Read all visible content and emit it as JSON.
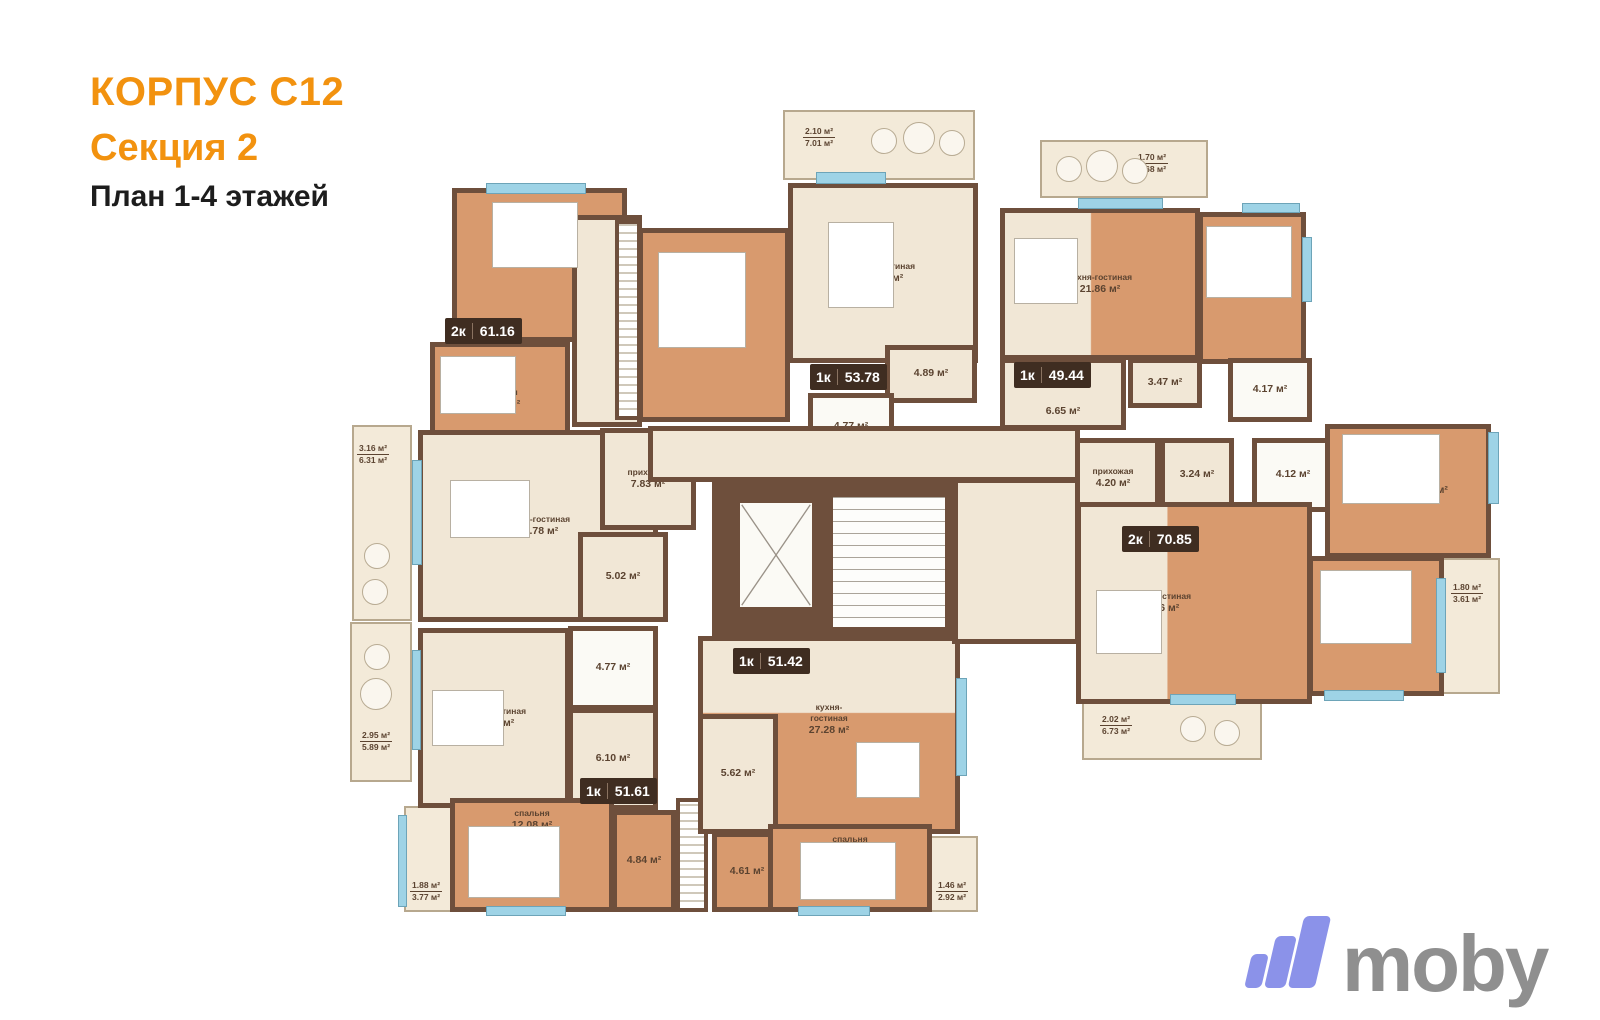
{
  "title": {
    "building": "КОРПУС С12",
    "section": "Секция 2",
    "plan": "План 1-4 этажей"
  },
  "apartments": {
    "a2k_6116": {
      "type": "2к",
      "area": "61.16"
    },
    "a1k_5378": {
      "type": "1к",
      "area": "53.78"
    },
    "a1k_4944": {
      "type": "1к",
      "area": "49.44"
    },
    "a2k_7085": {
      "type": "2к",
      "area": "70.85"
    },
    "a1k_5161": {
      "type": "1к",
      "area": "51.61"
    },
    "a1k_5142": {
      "type": "1к",
      "area": "51.42"
    }
  },
  "rooms": {
    "bedroom_1194": {
      "name": "спальня",
      "area": "11.94 м²"
    },
    "bedroom_1043": {
      "name": "спальня",
      "area": "10.43 м²"
    },
    "bedroom_1795": {
      "name": "спальня",
      "area": "17.95 м²"
    },
    "kitchen_2178": {
      "name": "кухня-гостиная",
      "area": "21.78 м²"
    },
    "hall_783": {
      "name": "прихожая",
      "area": "7.83 м²"
    },
    "bath_502": {
      "area": "5.02 м²"
    },
    "kitchen_2487": {
      "name": "кухня-гостиная",
      "area": "24.87 м²"
    },
    "hall_489": {
      "area": "4.89 м²"
    },
    "bath_477a": {
      "area": "4.77 м²"
    },
    "kitchen_2186": {
      "name": "кухня-гостиная",
      "area": "21.86 м²"
    },
    "bedroom_1150": {
      "name": "спальня",
      "area": "11.50 м²"
    },
    "hall_665": {
      "area": "6.65 м²"
    },
    "hall_347": {
      "area": "3.47 м²"
    },
    "bath_417": {
      "area": "4.17 м²"
    },
    "hall_420": {
      "name": "прихожая",
      "area": "4.20 м²"
    },
    "bath_324": {
      "area": "3.24 м²"
    },
    "bath_412": {
      "area": "4.12 м²"
    },
    "kitchen_2946": {
      "name": "кухня-гостиная",
      "area": "29.46 м²"
    },
    "bedroom_1387": {
      "name": "спальня",
      "area": "13.87 м²"
    },
    "bedroom_1293": {
      "name": "спальня",
      "area": "12.93 м²"
    },
    "kitchen_1899": {
      "name": "кухня-гостиная",
      "area": "18.99 м²"
    },
    "bath_477b": {
      "area": "4.77 м²"
    },
    "hall_610": {
      "area": "6.10 м²"
    },
    "bedroom_1208": {
      "name": "спальня",
      "area": "12.08 м²"
    },
    "hall_484": {
      "area": "4.84 м²"
    },
    "kitchen_2728": {
      "name": "кухня-гостиная",
      "area": "27.28 м²"
    },
    "bath_562": {
      "area": "5.62 м²"
    },
    "hall_461": {
      "area": "4.61 м²"
    },
    "bedroom_1244": {
      "name": "спальня",
      "area": "12.44 м²"
    }
  },
  "balconies": {
    "b_316": {
      "a": "3.16 м²",
      "b": "6.31 м²"
    },
    "b_210": {
      "a": "2.10 м²",
      "b": "7.01 м²"
    },
    "b_170": {
      "a": "1.70 м²",
      "b": "5.68 м²"
    },
    "b_180": {
      "a": "1.80 м²",
      "b": "3.61 м²"
    },
    "b_202": {
      "a": "2.02 м²",
      "b": "6.73 м²"
    },
    "b_295": {
      "a": "2.95 м²",
      "b": "5.89 м²"
    },
    "b_188": {
      "a": "1.88 м²",
      "b": "3.77 м²"
    },
    "b_146": {
      "a": "1.46 м²",
      "b": "2.92 м²"
    }
  },
  "brand": {
    "name": "moby"
  },
  "colors": {
    "accent_orange": "#F2920F",
    "wall_brown": "#6E4F3C",
    "wood_floor": "#D89A6E",
    "cream_floor": "#F1E7D6",
    "window_blue": "#9ED3E6",
    "badge_brown": "#3F2D21",
    "label_brown": "#5B4330",
    "logo_bar_purple": "#8B92E9",
    "logo_text_gray": "#8F8F8F"
  }
}
